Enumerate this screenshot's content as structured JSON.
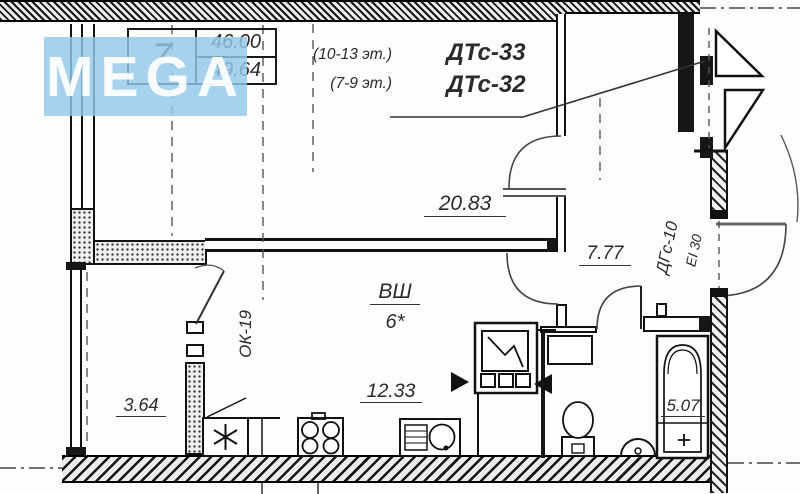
{
  "watermark": {
    "text": "MEGA"
  },
  "info_table": {
    "apartment_number": "7",
    "living_area": "46.00",
    "total_area": "49.64"
  },
  "type_labels": {
    "floors_a": "(10-13 эт.)",
    "type_a": "ДТс-33",
    "floors_b": "(7-9 эт.)",
    "type_b": "ДТс-32"
  },
  "rooms": {
    "living_area": "20.83",
    "hall_area": "7.77",
    "kitchen_area": "12.33",
    "loggia_area": "3.64",
    "bathroom_area": "5.07"
  },
  "annotations": {
    "vent_shaft": "ВШ",
    "rooms_note": "6*",
    "window_block_mark": "ОК-19",
    "fire_door_mark": "ДГс-10",
    "fire_rating": "EI 30"
  },
  "colors": {
    "line": "#1a1a1a",
    "text": "#2b2b2b",
    "watermark_bg": "#94c8e9",
    "watermark_text": "#ffffff"
  }
}
